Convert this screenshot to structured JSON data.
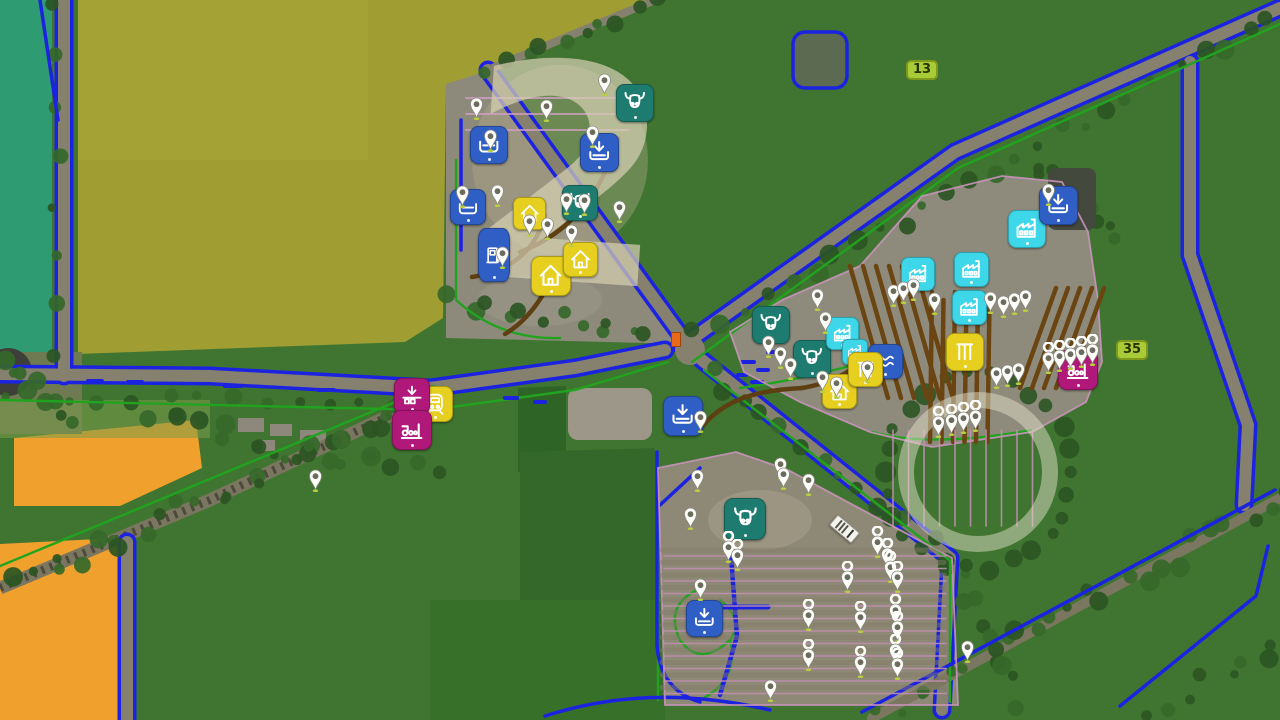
{
  "park_label": "2",
  "colors": {
    "icon_blue": "#2f5fc4",
    "icon_cyan": "#3ed7ea",
    "icon_teal": "#1d7c6f",
    "icon_yellow": "#e6cf1f",
    "icon_magenta": "#b0187a",
    "badge_bg": "#a9cb37",
    "badge_text": "#283400",
    "road_line_blue": "#1c23e0",
    "field_line_green": "#21a31f",
    "path_brown": "#5e3f12",
    "pin_white": "#fdfdfa",
    "pin_base_green": "#b9cf3f"
  },
  "field_badges": [
    {
      "label": "13",
      "x": 906,
      "y": 60
    },
    {
      "label": "35",
      "x": 1116,
      "y": 340
    }
  ],
  "markers": [
    {
      "name": "cow-pasture",
      "icon": "cow-icon",
      "color": "teal",
      "x": 616,
      "y": 84,
      "s": 36
    },
    {
      "name": "cow-pasture",
      "icon": "cow-icon",
      "color": "teal",
      "x": 562,
      "y": 185,
      "s": 34
    },
    {
      "name": "cow-pasture",
      "icon": "cow-icon",
      "color": "teal",
      "x": 752,
      "y": 306,
      "s": 36
    },
    {
      "name": "cow-pasture",
      "icon": "cow-icon",
      "color": "teal",
      "x": 793,
      "y": 340,
      "s": 36
    },
    {
      "name": "cow-pasture",
      "icon": "cow-icon",
      "color": "teal",
      "x": 724,
      "y": 498,
      "s": 40
    },
    {
      "name": "factory",
      "icon": "factory-icon",
      "color": "cyan",
      "x": 1008,
      "y": 210,
      "s": 36
    },
    {
      "name": "factory",
      "icon": "factory-icon",
      "color": "cyan",
      "x": 954,
      "y": 252,
      "s": 33
    },
    {
      "name": "factory",
      "icon": "factory-icon",
      "color": "cyan",
      "x": 952,
      "y": 290,
      "s": 33
    },
    {
      "name": "factory",
      "icon": "factory-icon",
      "color": "cyan",
      "x": 901,
      "y": 257,
      "s": 32
    },
    {
      "name": "factory",
      "icon": "factory-icon",
      "color": "cyan",
      "x": 826,
      "y": 317,
      "s": 31
    },
    {
      "name": "factory",
      "icon": "factory-icon",
      "color": "cyan",
      "x": 842,
      "y": 339,
      "s": 24
    },
    {
      "name": "unload-point",
      "icon": "tray-icon",
      "color": "blue",
      "x": 470,
      "y": 126,
      "s": 36
    },
    {
      "name": "unload-point",
      "icon": "download-icon",
      "color": "blue",
      "x": 580,
      "y": 133,
      "s": 37
    },
    {
      "name": "unload-point",
      "icon": "tray-icon",
      "color": "blue",
      "x": 450,
      "y": 189,
      "s": 34
    },
    {
      "name": "fuel-station",
      "icon": "fuel-icon",
      "color": "blue",
      "x": 478,
      "y": 228,
      "s": 30,
      "h": 52
    },
    {
      "name": "unload-point",
      "icon": "download-icon",
      "color": "blue",
      "x": 663,
      "y": 396,
      "s": 38
    },
    {
      "name": "unload-point",
      "icon": "download-icon",
      "color": "blue",
      "x": 1039,
      "y": 186,
      "s": 37
    },
    {
      "name": "wool-point",
      "icon": "waves-icon",
      "color": "blue",
      "x": 868,
      "y": 344,
      "s": 33
    },
    {
      "name": "unload-point",
      "icon": "download-icon",
      "color": "blue",
      "x": 686,
      "y": 600,
      "s": 35
    },
    {
      "name": "farmhouse",
      "icon": "house-icon",
      "color": "yellow",
      "x": 531,
      "y": 256,
      "s": 38
    },
    {
      "name": "farmhouse",
      "icon": "house-icon",
      "color": "yellow",
      "x": 563,
      "y": 242,
      "s": 33
    },
    {
      "name": "farmhouse",
      "icon": "house-icon",
      "color": "yellow",
      "x": 513,
      "y": 197,
      "s": 31
    },
    {
      "name": "train-station",
      "icon": "train-icon",
      "color": "yellow",
      "x": 417,
      "y": 386,
      "s": 34
    },
    {
      "name": "farmhouse",
      "icon": "house-icon",
      "color": "yellow",
      "x": 822,
      "y": 374,
      "s": 33
    },
    {
      "name": "silo",
      "icon": "bars-icon",
      "color": "yellow",
      "x": 848,
      "y": 352,
      "s": 33
    },
    {
      "name": "silo",
      "icon": "bars-icon",
      "color": "yellow",
      "x": 946,
      "y": 333,
      "s": 36
    },
    {
      "name": "train-unload",
      "icon": "platform-unload-icon",
      "color": "magenta",
      "x": 394,
      "y": 378,
      "s": 34
    },
    {
      "name": "production",
      "icon": "production-icon",
      "color": "magenta",
      "x": 392,
      "y": 410,
      "s": 38
    },
    {
      "name": "production",
      "icon": "production-icon",
      "color": "magenta",
      "x": 1058,
      "y": 350,
      "s": 38
    }
  ],
  "pins": [
    {
      "x": 604,
      "y": 96,
      "g": 0
    },
    {
      "x": 546,
      "y": 122,
      "g": 0
    },
    {
      "x": 476,
      "y": 120,
      "g": 0
    },
    {
      "x": 490,
      "y": 152,
      "g": 0
    },
    {
      "x": 592,
      "y": 148,
      "g": 0
    },
    {
      "x": 497,
      "y": 207,
      "g": 0
    },
    {
      "x": 584,
      "y": 216,
      "g": 0
    },
    {
      "x": 619,
      "y": 223,
      "g": 0
    },
    {
      "x": 566,
      "y": 215,
      "g": 0
    },
    {
      "x": 529,
      "y": 237,
      "g": 0
    },
    {
      "x": 547,
      "y": 240,
      "g": 0
    },
    {
      "x": 571,
      "y": 247,
      "g": 0
    },
    {
      "x": 502,
      "y": 269,
      "g": 0
    },
    {
      "x": 462,
      "y": 208,
      "g": 0
    },
    {
      "x": 768,
      "y": 358,
      "g": 0
    },
    {
      "x": 780,
      "y": 369,
      "g": 0
    },
    {
      "x": 790,
      "y": 380,
      "g": 0
    },
    {
      "x": 817,
      "y": 311,
      "g": 0
    },
    {
      "x": 825,
      "y": 334,
      "g": 0
    },
    {
      "x": 867,
      "y": 383,
      "g": 0
    },
    {
      "x": 893,
      "y": 307,
      "g": 0
    },
    {
      "x": 903,
      "y": 304,
      "g": 0
    },
    {
      "x": 913,
      "y": 301,
      "g": 0
    },
    {
      "x": 934,
      "y": 315,
      "g": 0
    },
    {
      "x": 990,
      "y": 314,
      "g": 0
    },
    {
      "x": 822,
      "y": 393,
      "g": 0
    },
    {
      "x": 836,
      "y": 399,
      "g": 0
    },
    {
      "x": 1003,
      "y": 318,
      "g": 0
    },
    {
      "x": 1014,
      "y": 315,
      "g": 0
    },
    {
      "x": 1025,
      "y": 312,
      "g": 0
    },
    {
      "x": 996,
      "y": 389,
      "g": 0
    },
    {
      "x": 1007,
      "y": 387,
      "g": 0
    },
    {
      "x": 1018,
      "y": 385,
      "g": 0
    },
    {
      "x": 1048,
      "y": 206,
      "g": 0
    },
    {
      "x": 1048,
      "y": 374,
      "g": 1
    },
    {
      "x": 1059,
      "y": 372,
      "g": 1
    },
    {
      "x": 1070,
      "y": 370,
      "g": 1
    },
    {
      "x": 1081,
      "y": 368,
      "g": 1
    },
    {
      "x": 1092,
      "y": 366,
      "g": 1
    },
    {
      "x": 938,
      "y": 438,
      "g": 1
    },
    {
      "x": 951,
      "y": 436,
      "g": 1
    },
    {
      "x": 963,
      "y": 434,
      "g": 1
    },
    {
      "x": 975,
      "y": 432,
      "g": 1
    },
    {
      "x": 697,
      "y": 492,
      "g": 0
    },
    {
      "x": 690,
      "y": 530,
      "g": 0
    },
    {
      "x": 728,
      "y": 563,
      "g": 1
    },
    {
      "x": 737,
      "y": 571,
      "g": 1
    },
    {
      "x": 700,
      "y": 601,
      "g": 0
    },
    {
      "x": 780,
      "y": 480,
      "g": 0
    },
    {
      "x": 783,
      "y": 490,
      "g": 0
    },
    {
      "x": 808,
      "y": 496,
      "g": 0
    },
    {
      "x": 877,
      "y": 558,
      "g": 1
    },
    {
      "x": 887,
      "y": 570,
      "g": 1
    },
    {
      "x": 890,
      "y": 583,
      "g": 1
    },
    {
      "x": 897,
      "y": 593,
      "g": 1
    },
    {
      "x": 895,
      "y": 626,
      "g": 1
    },
    {
      "x": 897,
      "y": 643,
      "g": 1
    },
    {
      "x": 895,
      "y": 666,
      "g": 1
    },
    {
      "x": 897,
      "y": 680,
      "g": 1
    },
    {
      "x": 847,
      "y": 593,
      "g": 1
    },
    {
      "x": 808,
      "y": 631,
      "g": 1
    },
    {
      "x": 860,
      "y": 633,
      "g": 1
    },
    {
      "x": 808,
      "y": 671,
      "g": 1
    },
    {
      "x": 860,
      "y": 678,
      "g": 1
    },
    {
      "x": 967,
      "y": 663,
      "g": 0
    },
    {
      "x": 770,
      "y": 702,
      "g": 0
    },
    {
      "x": 700,
      "y": 433,
      "g": 0
    },
    {
      "x": 315,
      "y": 492,
      "g": 0
    }
  ],
  "vehicles": [
    {
      "name": "truck",
      "x": 830,
      "y": 522,
      "rot": 40
    },
    {
      "name": "implement",
      "x": 671,
      "y": 332,
      "rot": 0
    }
  ]
}
